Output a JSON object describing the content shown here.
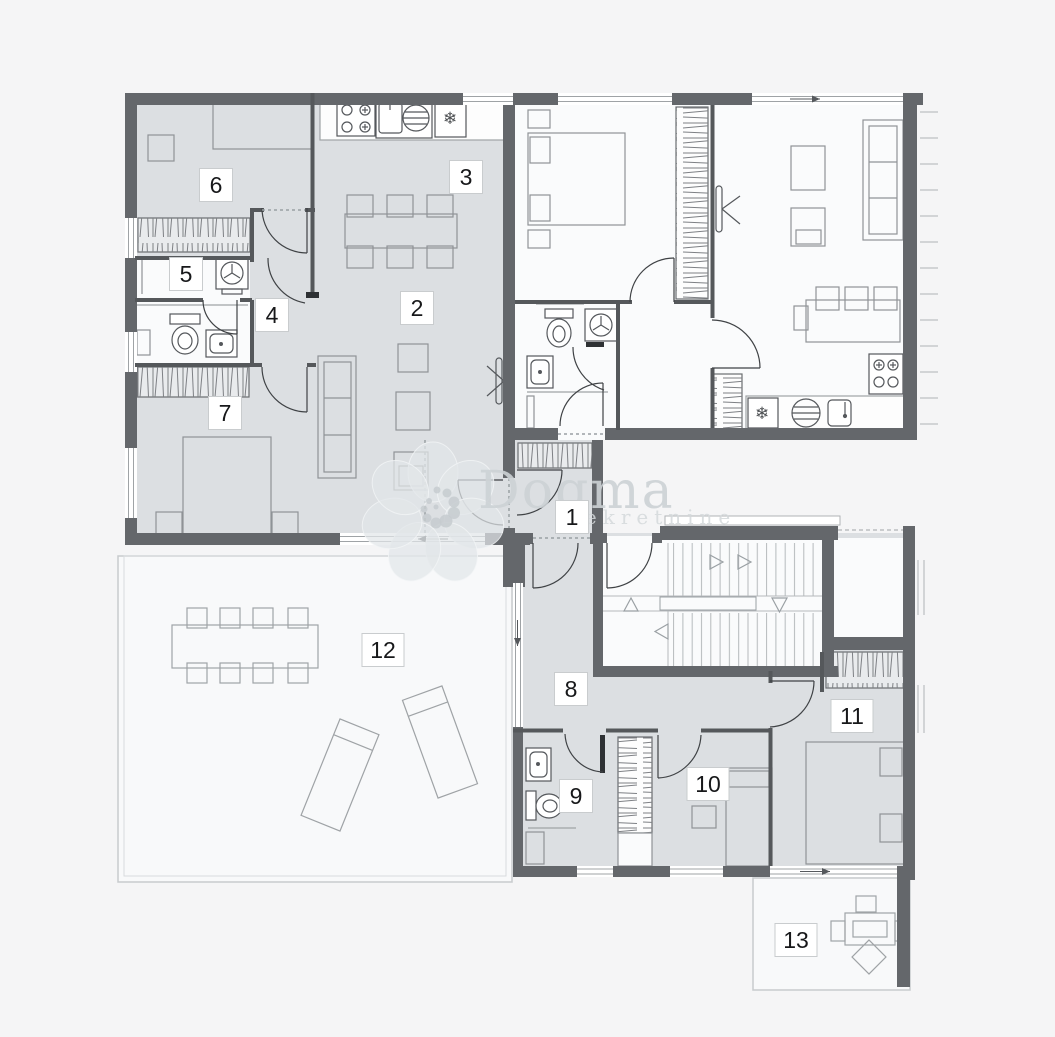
{
  "canvas": {
    "width": 1055,
    "height": 1037,
    "background": "#f5f5f6"
  },
  "palette": {
    "wall": "#64676b",
    "partition": "#55585b",
    "floor_shaded": "#dcdfe2",
    "floor_light": "#fafbfc",
    "terrace_floor": "#f8f9fa",
    "furniture_line": "#8f9397",
    "fixture_line": "#55585c",
    "door_arc": "#3f4245",
    "label_border": "#c9ccce",
    "label_text": "#17181a",
    "watermark_text": "#ccd1d5",
    "watermark_petal": "#e2e6e9"
  },
  "watermark": {
    "brand": "Dogma",
    "tagline": "nekretnine"
  },
  "icons": {
    "freezer": "❄"
  },
  "rooms": [
    {
      "number": "1"
    },
    {
      "number": "2"
    },
    {
      "number": "3"
    },
    {
      "number": "4"
    },
    {
      "number": "5"
    },
    {
      "number": "6"
    },
    {
      "number": "7"
    },
    {
      "number": "8"
    },
    {
      "number": "9"
    },
    {
      "number": "10"
    },
    {
      "number": "11"
    },
    {
      "number": "12"
    },
    {
      "number": "13"
    }
  ]
}
